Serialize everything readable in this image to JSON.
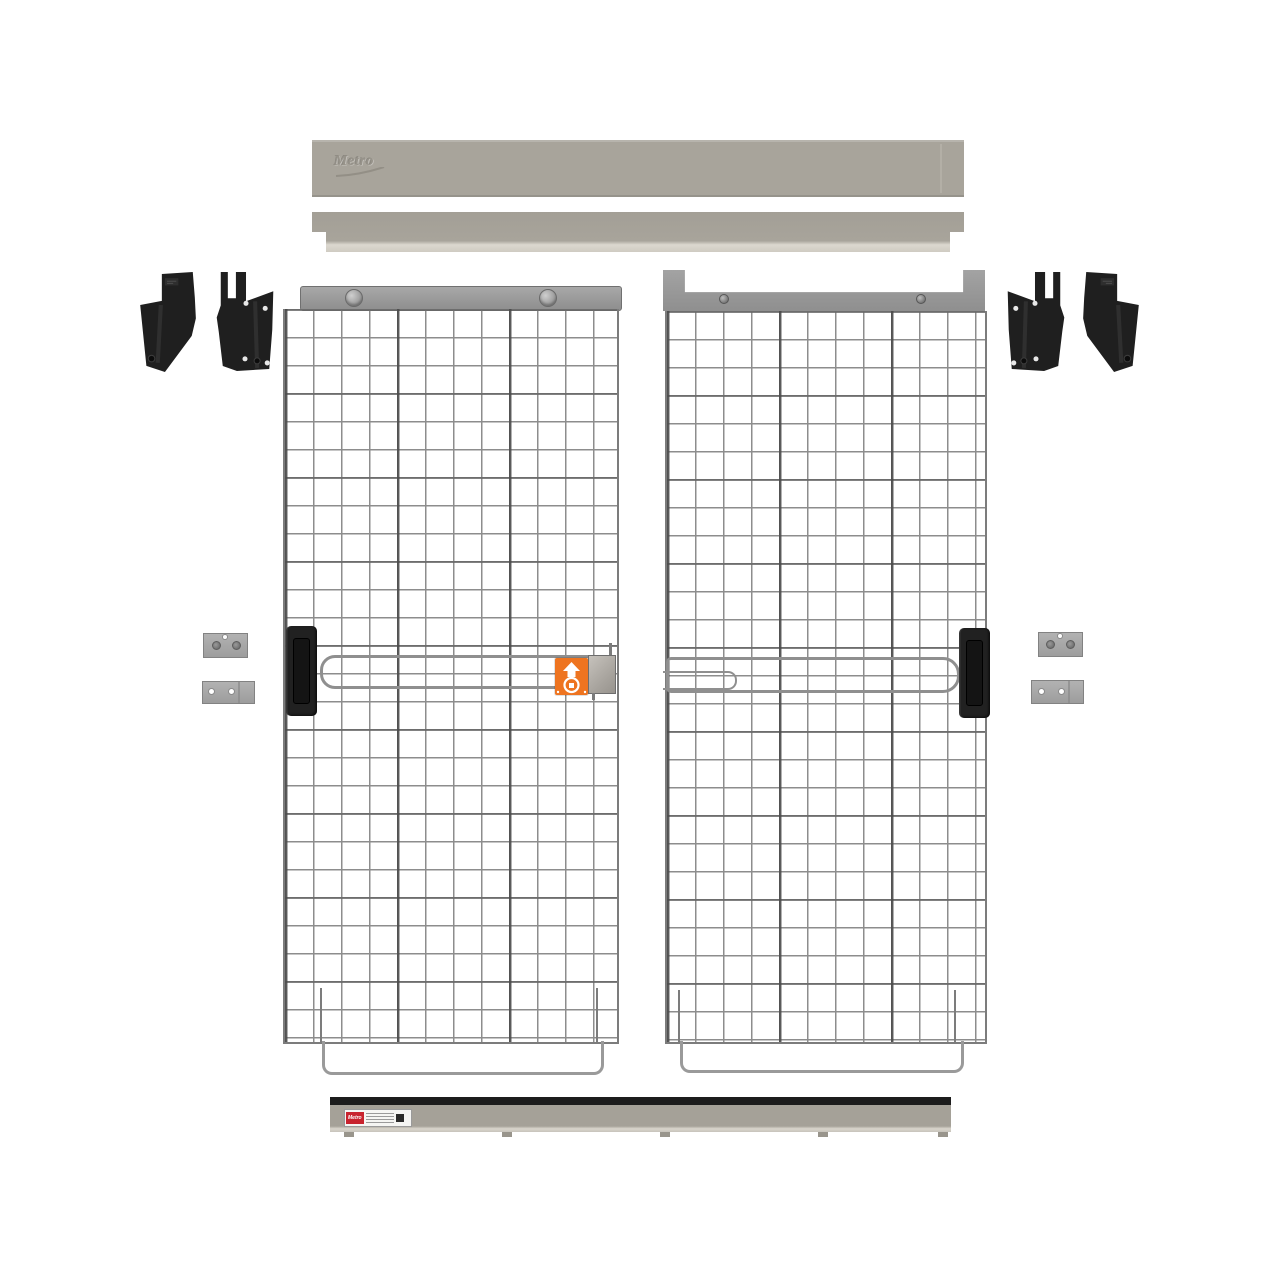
{
  "image": {
    "description": "Exploded parts view of a wire-mesh sliding double-door kit: top track cover with embossed Metro logo, upper track, two mesh doors with black handles, slide latch with orange safety sticker, four black mounting brackets, four gray mounting plates, and a bottom floor track with a small Metro label.",
    "background_color": "#ffffff"
  },
  "branding": {
    "top_cover_logo": "Metro",
    "bottom_label_brand": "Metro"
  },
  "icons": {
    "safety_label_primary": "lift-up-arrow-icon",
    "safety_label_secondary": "padlock-ring-icon",
    "logo_underline": "swoosh-underline-icon"
  },
  "colors": {
    "rail_gray": "#a8a49b",
    "rail_highlight": "#dcd8cf",
    "header_gray": "#9b9b9b",
    "mesh_wire": "#8d8d8d",
    "mesh_wire_heavy": "#5c5c5c",
    "black_hardware": "#1f1f1f",
    "plate_gray": "#a9a9a9",
    "safety_orange": "#ee7420",
    "label_red": "#c8232e",
    "track_black": "#1c1c1c"
  }
}
